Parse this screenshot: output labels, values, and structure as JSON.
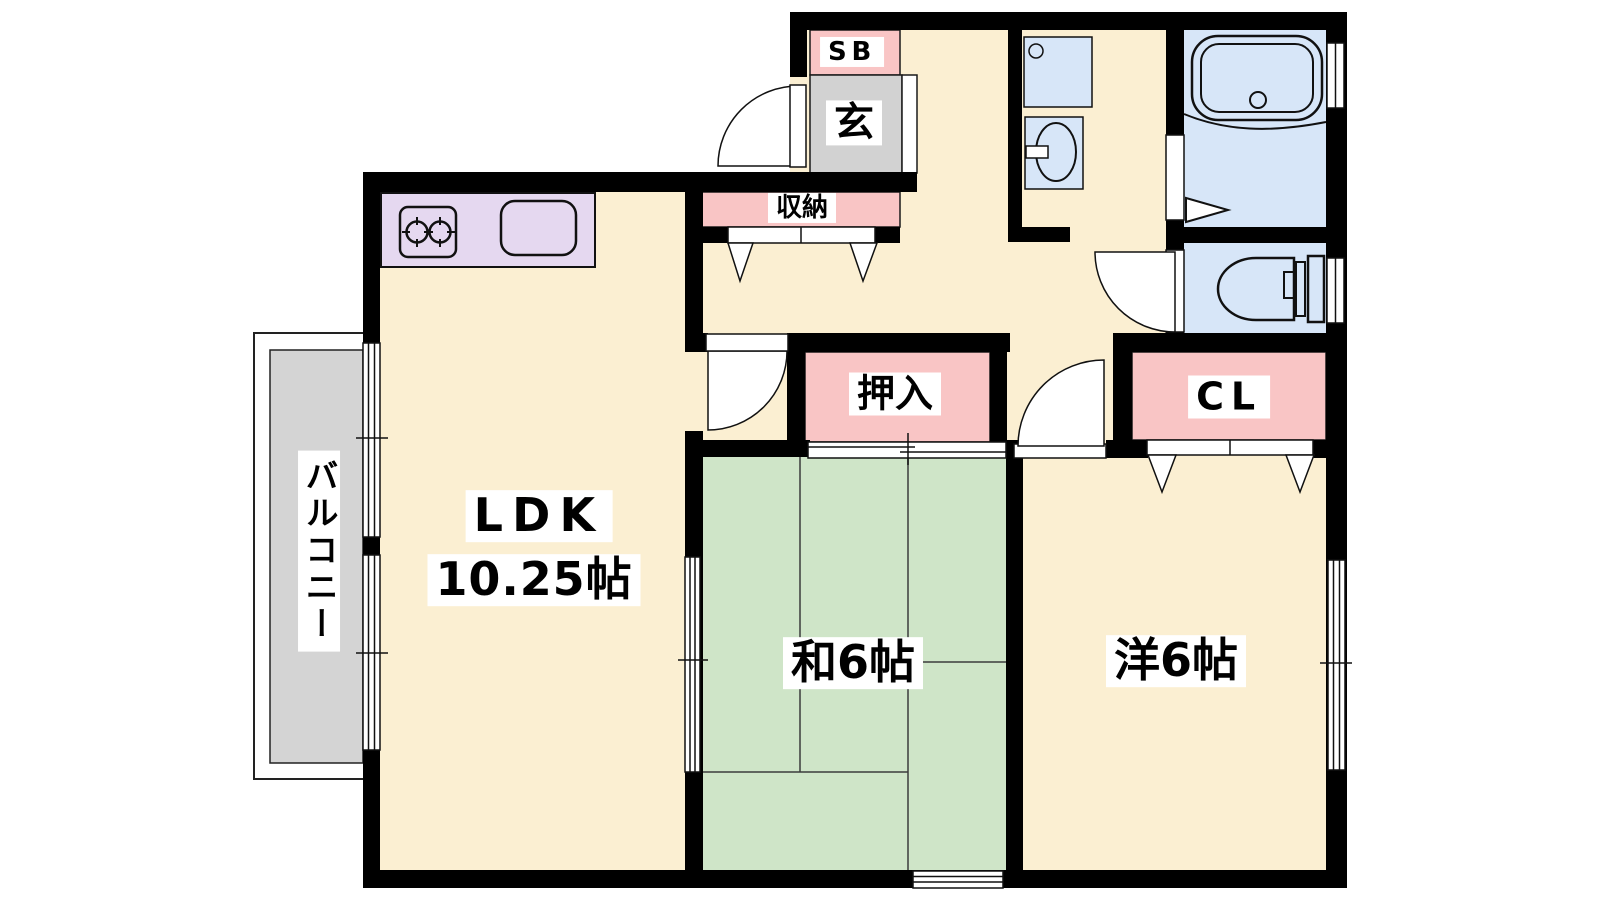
{
  "rooms": {
    "ldk": {
      "name": "LDK",
      "size": "10.25帖"
    },
    "washitsu": {
      "name": "和6帖"
    },
    "youshitsu": {
      "name": "洋6帖"
    },
    "balcony": {
      "name": "バルコニー"
    },
    "genkan": {
      "name": "玄"
    },
    "shoebox": {
      "name": "SB"
    },
    "storage": {
      "name": "収納"
    },
    "oshiire": {
      "name": "押入"
    },
    "closet": {
      "name": "CL"
    }
  },
  "colors": {
    "floor_cream": "#FBEFD2",
    "tatami_green": "#CFE5C8",
    "closet_pink": "#F9C5C5",
    "wet_area_blue": "#D7E6F8",
    "kitchen_lavender": "#E5D8F0",
    "genkan_gray": "#D2D2D2",
    "balcony_gray": "#D4D4D4",
    "wall_black": "#000000"
  }
}
